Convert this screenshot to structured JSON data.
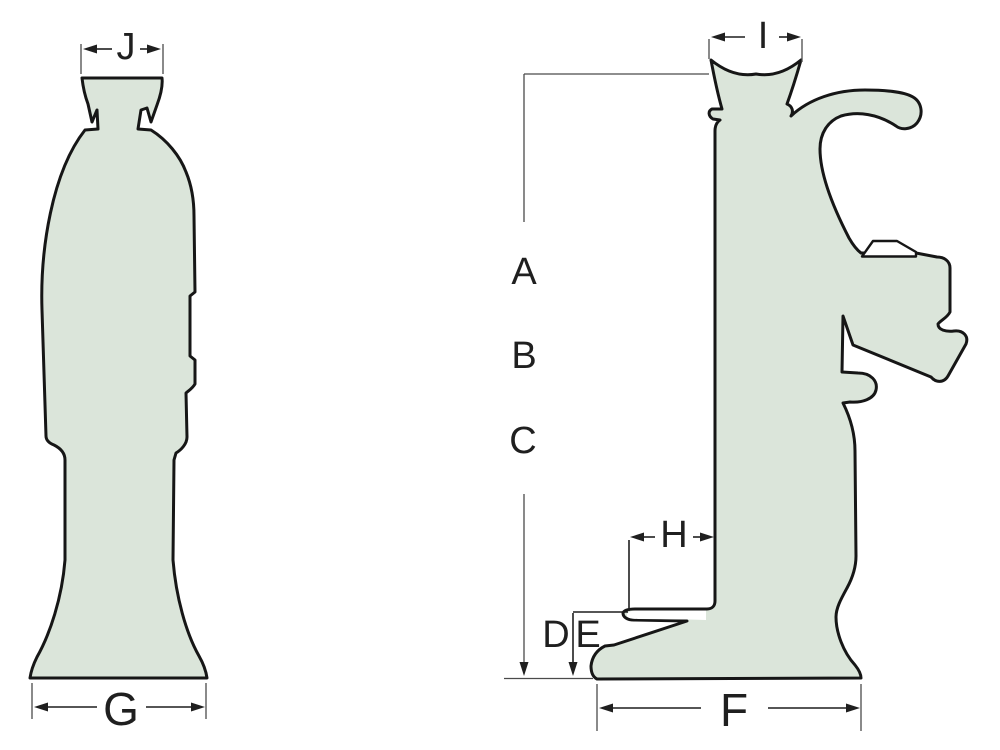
{
  "labels": {
    "a": "A",
    "b": "B",
    "c": "C",
    "d": "D",
    "e": "E",
    "f": "F",
    "g": "G",
    "h": "H",
    "i": "I",
    "j": "J"
  },
  "colors": {
    "background": "#ffffff",
    "body_fill": "#dbe5da",
    "outline": "#161616",
    "dimension": "#1f1f1f",
    "extension": "#4a4a4a",
    "cutout": "#ffffff"
  }
}
